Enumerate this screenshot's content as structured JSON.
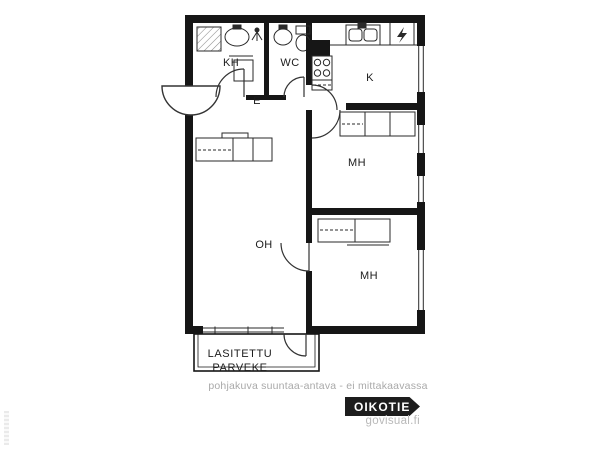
{
  "floorplan": {
    "rooms": [
      {
        "id": "kh",
        "label": "KH"
      },
      {
        "id": "wc",
        "label": "WC"
      },
      {
        "id": "k",
        "label": "K"
      },
      {
        "id": "e",
        "label": "E"
      },
      {
        "id": "mh1",
        "label": "MH"
      },
      {
        "id": "oh",
        "label": "OH"
      },
      {
        "id": "mh2",
        "label": "MH"
      }
    ],
    "balcony": {
      "line1": "LASITETTU",
      "line2": "PARVEKE"
    }
  },
  "footer": {
    "disclaimer": "pohjakuva suuntaa-antava - ei mittakaavassa",
    "brand": "OIKOTIE",
    "credit": "govisual.fi"
  },
  "colors": {
    "wall": "#161616",
    "line": "#2a2a2a",
    "muted_text": "#a9a9a9",
    "badge_bg": "#1d1d1d",
    "badge_text": "#ffffff"
  }
}
